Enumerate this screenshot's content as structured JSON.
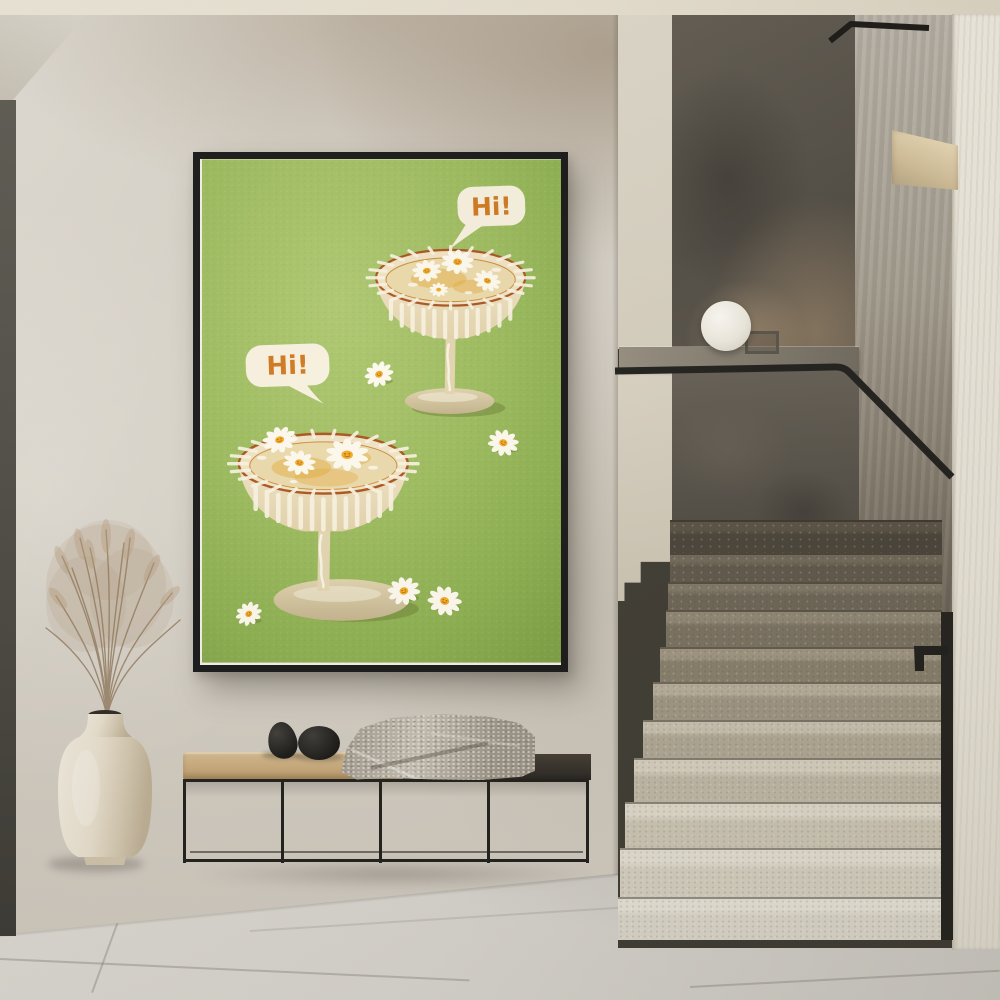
{
  "scene": {
    "description": "Entry hall photo: framed daisy-cocktail poster on plaster wall, metal bench with blanket and stones, ceramic vase with dried grass, terrazzo staircase with black handrail and sphere lamp"
  },
  "palette": {
    "wall": "#d6d1c8",
    "ceiling": "#eae4d6",
    "floor": "#d6d3cc",
    "frame": "#151515",
    "stair_light": "#d9d4c6",
    "stair_dark": "#5f584b",
    "rail": "#1c1b18",
    "bench_wood": "#c8ab7d",
    "bench_dark": "#2c2823",
    "blanket": "#b6afa2",
    "vase": "#e9e2d3",
    "lamp": "#f4f1e9"
  },
  "artwork": {
    "bubble_back_text": "Hi!",
    "bubble_front_text": "Hi!",
    "colors": {
      "background": "#9cb757",
      "bubble": "#f6efdc",
      "text": "#ce761b",
      "glass": "#eee1c0",
      "drink": "#e9d8a8",
      "rim_line": "#a8521c",
      "daisy_petal": "#fbf7ea",
      "daisy_center": "#f0a81f"
    },
    "glasses": [
      {
        "name": "back",
        "rim": {
          "cx": 250,
          "cy": 119,
          "rx": 75,
          "ry": 28
        },
        "rays_n": 24,
        "stripes_count": 12,
        "stripes_h": 26,
        "daisies": [
          {
            "x": 226,
            "y": 112,
            "s": 0.85,
            "rot": -10,
            "face": true
          },
          {
            "x": 257,
            "y": 103,
            "s": 0.95,
            "rot": 5,
            "face": true
          },
          {
            "x": 287,
            "y": 122,
            "s": 0.8,
            "rot": 20,
            "face": true
          },
          {
            "x": 238,
            "y": 131,
            "s": 0.55,
            "rot": 0,
            "face": false
          }
        ]
      },
      {
        "name": "front",
        "rim": {
          "cx": 122,
          "cy": 306,
          "rx": 85,
          "ry": 30
        },
        "rays_n": 26,
        "stripes_count": 13,
        "stripes_h": 30,
        "daisies": [
          {
            "x": 78,
            "y": 282,
            "s": 1.0,
            "rot": -15,
            "face": true
          },
          {
            "x": 98,
            "y": 305,
            "s": 0.95,
            "rot": 10,
            "face": true
          },
          {
            "x": 146,
            "y": 297,
            "s": 1.25,
            "rot": 0,
            "face": true
          }
        ]
      }
    ],
    "loose_daisies": [
      {
        "x": 178,
        "y": 216,
        "s": 0.85,
        "rot": -25,
        "face": true
      },
      {
        "x": 303,
        "y": 285,
        "s": 0.9,
        "rot": 12,
        "face": true
      },
      {
        "x": 203,
        "y": 434,
        "s": 0.95,
        "rot": -12,
        "face": true
      },
      {
        "x": 244,
        "y": 444,
        "s": 1.0,
        "rot": 18,
        "face": true
      },
      {
        "x": 47,
        "y": 457,
        "s": 0.78,
        "rot": -30,
        "face": true
      }
    ]
  }
}
